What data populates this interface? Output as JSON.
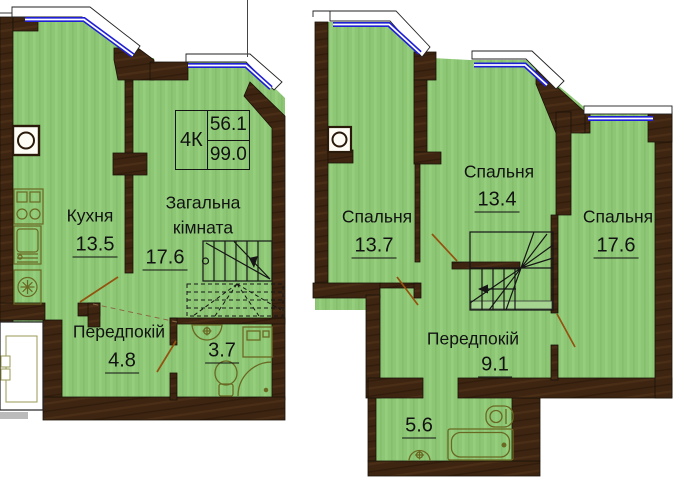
{
  "left_plan": {
    "info_box": {
      "type": "4К",
      "area_level": "56.1",
      "area_total": "99.0"
    },
    "rooms": {
      "kitchen": {
        "name": "Кухня",
        "area": "13.5"
      },
      "living": {
        "name": "Загальна кімната",
        "area": "17.6"
      },
      "hall": {
        "name": "Передпокій",
        "area": "4.8"
      },
      "bathroom": {
        "area": "3.7"
      }
    }
  },
  "right_plan": {
    "rooms": {
      "bedroom_left": {
        "name": "Спальня",
        "area": "13.7"
      },
      "bedroom_middle": {
        "name": "Спальня",
        "area": "13.4"
      },
      "bedroom_right": {
        "name": "Спальня",
        "area": "17.6"
      },
      "hall": {
        "name": "Передпокій",
        "area": "9.1"
      },
      "bathroom": {
        "area": "5.6"
      }
    }
  },
  "palette": {
    "room_fill": "#8dc776",
    "wall": "#3e2512",
    "window_glass": "#1f1fd6",
    "door_swing": "#94520f"
  }
}
